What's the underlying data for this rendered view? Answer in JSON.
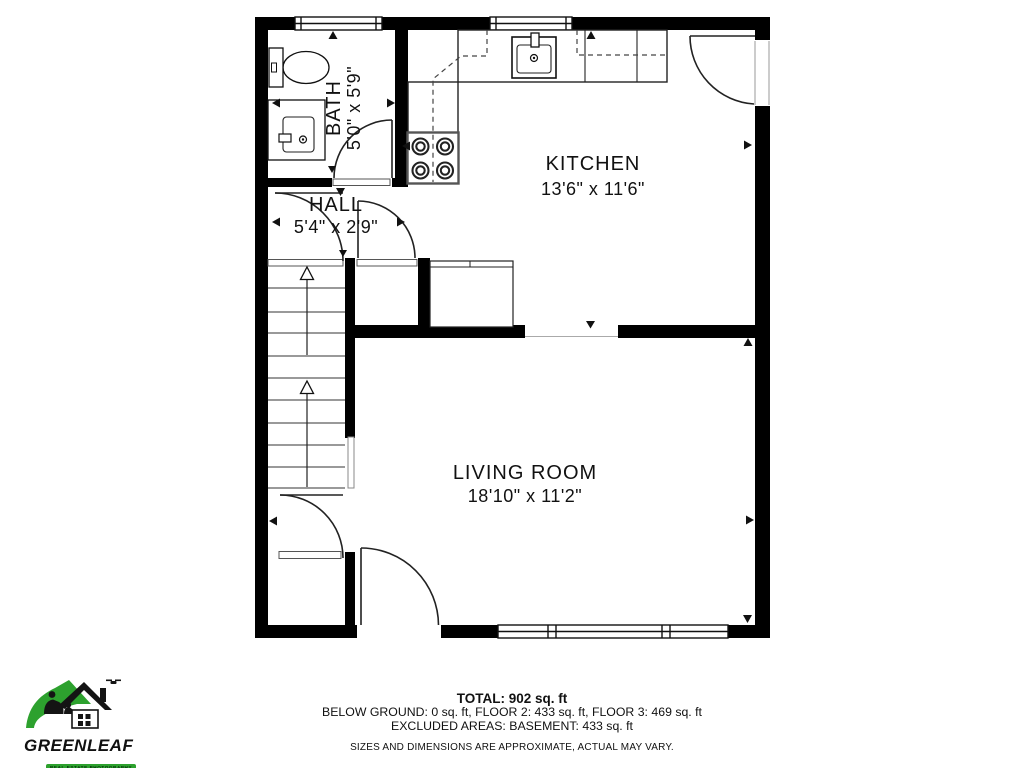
{
  "rooms": {
    "bath": {
      "name": "BATH",
      "dims": "5'0\" x 5'9\""
    },
    "hall": {
      "name": "HALL",
      "dims": "5'4\" x 2'9\""
    },
    "kitchen": {
      "name": "KITCHEN",
      "dims": "13'6\" x 11'6\""
    },
    "living_room": {
      "name": "LIVING ROOM",
      "dims": "18'10\" x 11'2\""
    }
  },
  "summary": {
    "total": "TOTAL: 902 sq. ft",
    "floors": "BELOW GROUND: 0 sq. ft, FLOOR 2: 433 sq. ft, FLOOR 3: 469 sq. ft",
    "excluded": "EXCLUDED AREAS: BASEMENT: 433 sq. ft",
    "disclaimer": "SIZES AND DIMENSIONS ARE APPROXIMATE, ACTUAL MAY VARY."
  },
  "brand": {
    "name": "GREENLEAF",
    "tagline": "REAL ESTATE PHOTOGRAPHY",
    "accent_green": "#2da12e"
  }
}
